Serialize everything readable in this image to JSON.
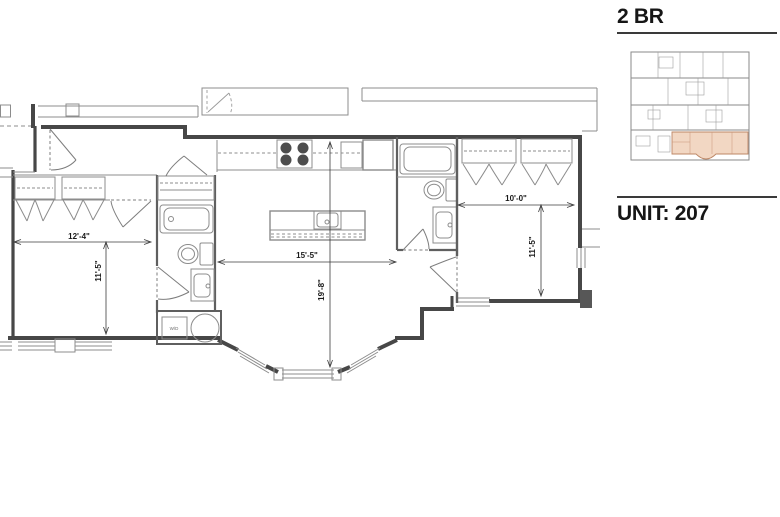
{
  "sidebar": {
    "unit_type_label": "2 BR",
    "unit_number_label": "UNIT: 207"
  },
  "key_plan": {
    "highlight_fill": "#f2d7c3",
    "highlight_stroke": "#bd8766"
  },
  "floor_plan": {
    "dimensions": {
      "bedroom1_width": "12'-4\"",
      "bedroom1_depth": "11'-5\"",
      "living_width": "15'-5\"",
      "living_depth": "19'-8\"",
      "bedroom2_width": "10'-0\"",
      "bedroom2_depth": "11'-5\""
    },
    "labels": {
      "washer_dryer": "W/D"
    },
    "colors": {
      "wall": "#474747",
      "partition": "#5f5f5f",
      "thin_line": "#8c8c8c",
      "dimension": "#3c3c3c"
    }
  }
}
